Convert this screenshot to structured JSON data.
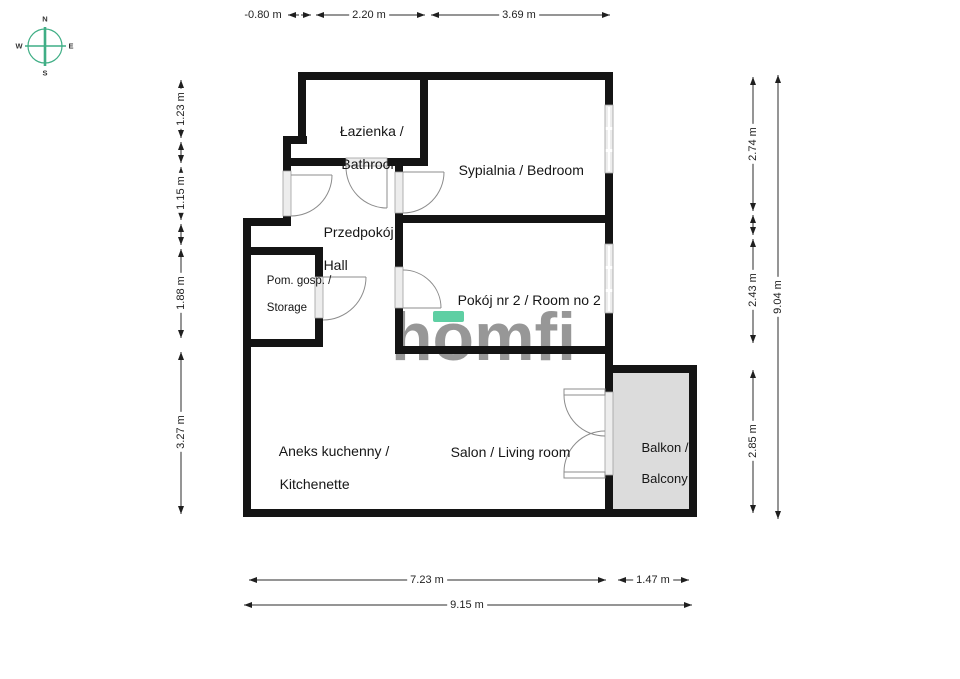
{
  "compass": {
    "north": "N",
    "east": "E",
    "south": "S",
    "west": "W"
  },
  "logo": {
    "brand": "homfi"
  },
  "rooms": {
    "bathroom": {
      "line1": "Łazienka /",
      "line2": "Bathroom"
    },
    "bedroom": {
      "line1": "Sypialnia / Bedroom"
    },
    "hall": {
      "line1": "Przedpokój /",
      "line2": "Hall"
    },
    "storage": {
      "line1": "Pom. gosp. /",
      "line2": "Storage"
    },
    "room2": {
      "line1": "Pokój nr 2 / Room no 2"
    },
    "kitchenette": {
      "line1": "Aneks kuchenny /",
      "line2": "Kitchenette"
    },
    "living": {
      "line1": "Salon / Living room"
    },
    "balcony": {
      "line1": "Balkon /",
      "line2": "Balcony"
    }
  },
  "dimensions": {
    "top_offset": "-0.80 m",
    "top_bathroom_width": "2.20 m",
    "top_bedroom_width": "3.69 m",
    "left_bathroom": "1.23 m",
    "left_entry": "1.15 m",
    "left_storage": "1.88 m",
    "left_kitchen": "3.27 m",
    "right_bedroom": "2.74 m",
    "right_room2": "2.43 m",
    "right_balcony": "2.85 m",
    "right_total": "9.04 m",
    "bottom_living": "7.23 m",
    "bottom_balcony": "1.47 m",
    "bottom_total": "9.15 m"
  },
  "colors": {
    "wall": "#141414",
    "balcony_fill": "#dcdcdc",
    "window_fill": "#ededed",
    "door_arc": "#8c8c8c",
    "dimension_line": "#2b2b2b",
    "compass_green": "#3fae85",
    "logo_gray": "#8f8f8f",
    "logo_accent": "#5ecfa3"
  }
}
